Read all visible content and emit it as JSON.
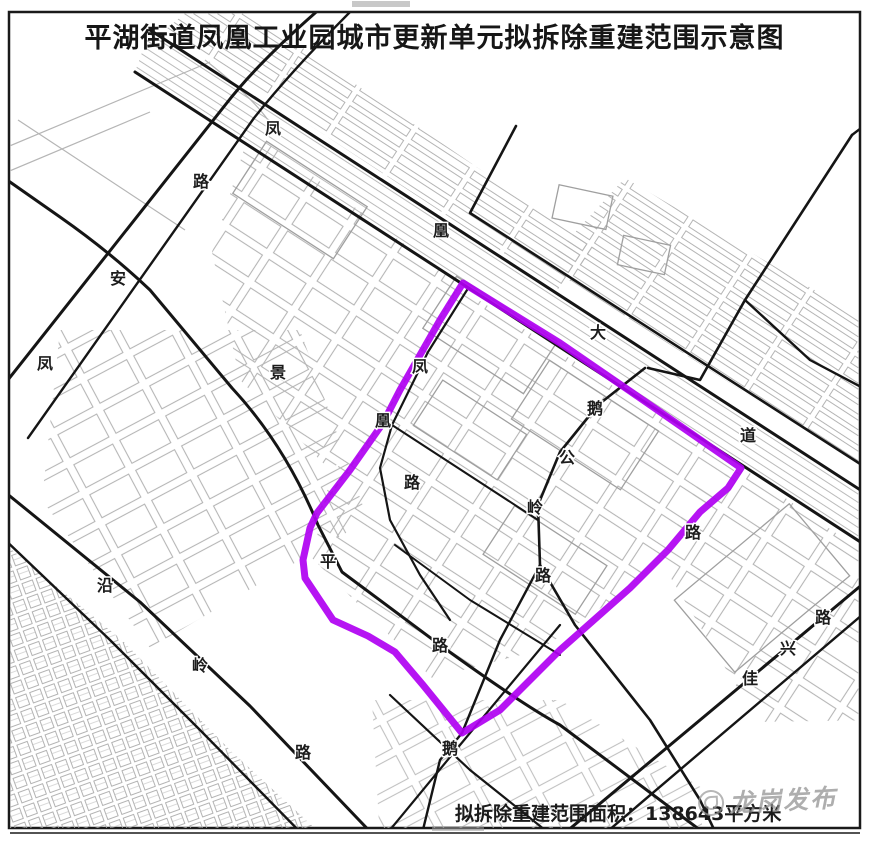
{
  "title": "平湖街道凤凰工业园城市更新单元拟拆除重建范围示意图",
  "footer": {
    "area_label": "拟拆除重建范围面积：",
    "area_value": "138643",
    "area_unit": "平方米"
  },
  "watermark": {
    "text": "龙岗发布"
  },
  "map": {
    "boundary_color": "#b000f2",
    "road_color": "#151515",
    "building_color": "#b3b3b3",
    "road_labels": [
      {
        "name": "凤凰大道",
        "chars": [
          {
            "ch": "凤",
            "x": 273,
            "y": 128
          },
          {
            "ch": "凰",
            "x": 441,
            "y": 230
          },
          {
            "ch": "大",
            "x": 598,
            "y": 332
          },
          {
            "ch": "道",
            "x": 748,
            "y": 435
          }
        ]
      },
      {
        "name": "凤安路",
        "chars": [
          {
            "ch": "路",
            "x": 201,
            "y": 181
          },
          {
            "ch": "安",
            "x": 118,
            "y": 278
          },
          {
            "ch": "凤",
            "x": 45,
            "y": 363
          }
        ]
      },
      {
        "name": "景",
        "chars": [
          {
            "ch": "景",
            "x": 278,
            "y": 372
          }
        ]
      },
      {
        "name": "凤凰路",
        "chars": [
          {
            "ch": "凤",
            "x": 420,
            "y": 366
          },
          {
            "ch": "凰",
            "x": 383,
            "y": 420
          },
          {
            "ch": "路",
            "x": 412,
            "y": 482
          }
        ]
      },
      {
        "name": "平路",
        "chars": [
          {
            "ch": "平",
            "x": 328,
            "y": 561
          },
          {
            "ch": "路",
            "x": 440,
            "y": 645
          }
        ]
      },
      {
        "name": "鹅公岭路",
        "chars": [
          {
            "ch": "鹅",
            "x": 595,
            "y": 408
          },
          {
            "ch": "公",
            "x": 567,
            "y": 457
          },
          {
            "ch": "岭",
            "x": 535,
            "y": 507
          },
          {
            "ch": "路",
            "x": 543,
            "y": 575
          }
        ]
      },
      {
        "name": "鹅",
        "chars": [
          {
            "ch": "鹅",
            "x": 450,
            "y": 748
          }
        ]
      },
      {
        "name": "路",
        "chars": [
          {
            "ch": "路",
            "x": 693,
            "y": 532
          }
        ]
      },
      {
        "name": "佳兴路",
        "chars": [
          {
            "ch": "佳",
            "x": 750,
            "y": 678
          },
          {
            "ch": "兴",
            "x": 788,
            "y": 648
          },
          {
            "ch": "路",
            "x": 823,
            "y": 617
          }
        ]
      },
      {
        "name": "沿岭路",
        "chars": [
          {
            "ch": "沿",
            "x": 105,
            "y": 585
          },
          {
            "ch": "岭",
            "x": 200,
            "y": 665
          },
          {
            "ch": "路",
            "x": 303,
            "y": 752
          }
        ]
      }
    ]
  }
}
